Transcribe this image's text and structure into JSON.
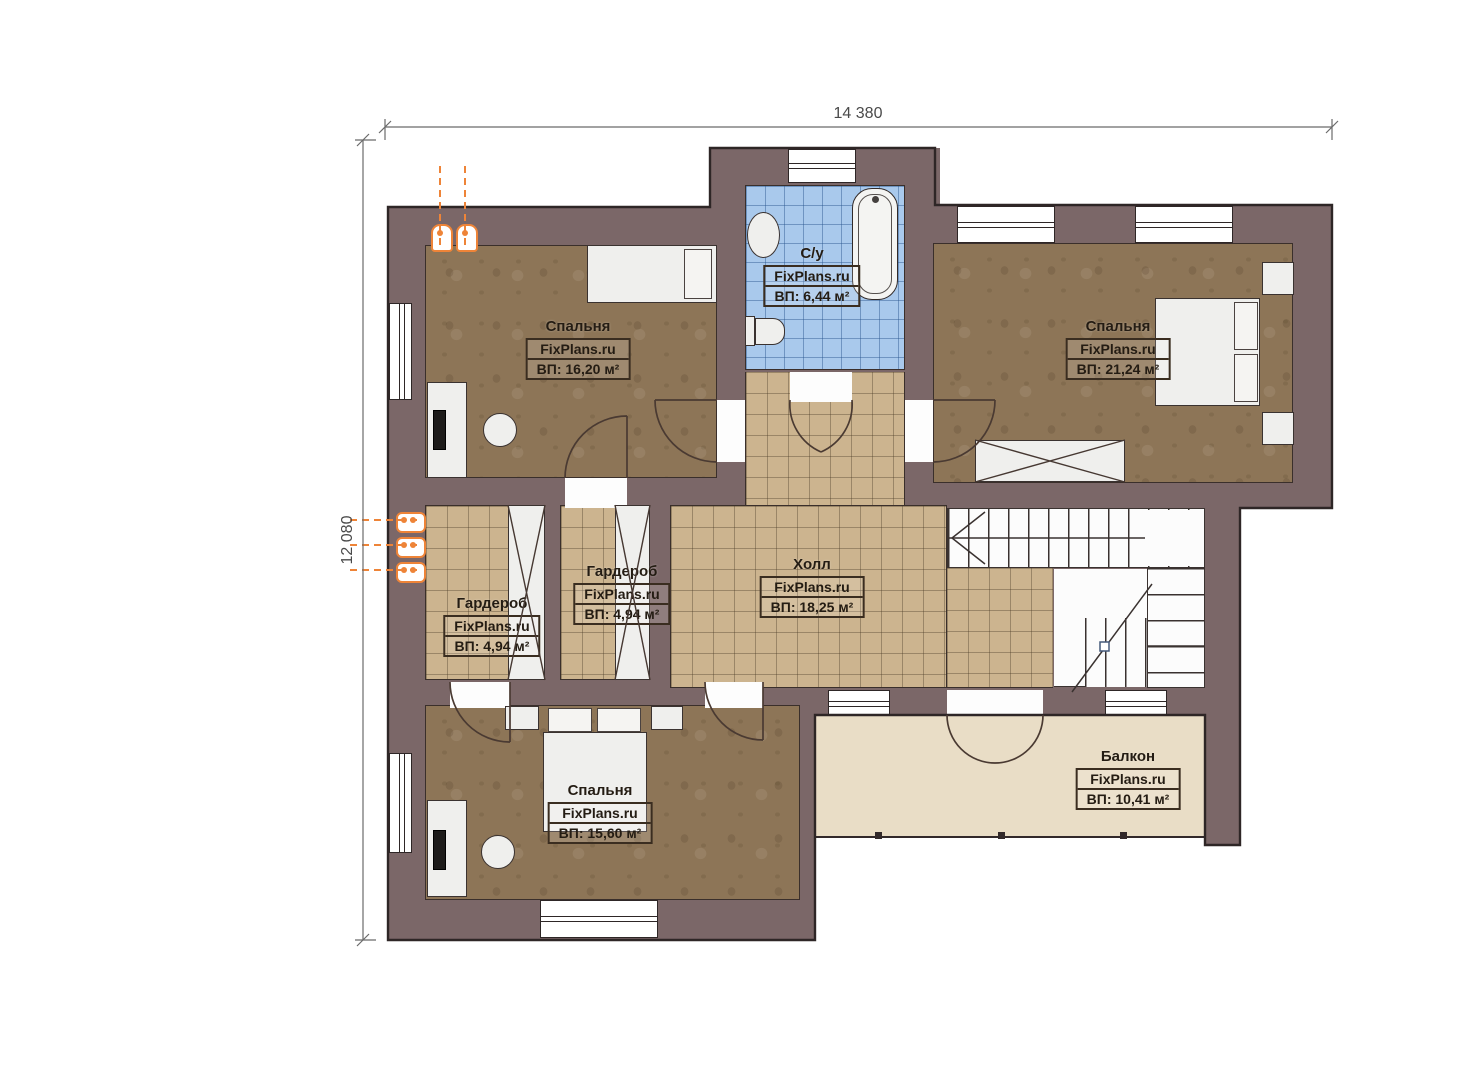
{
  "title": "Floor plan",
  "watermark": "FixPlans.ru",
  "dimensions": {
    "top": "14 380",
    "left": "12 080"
  },
  "rooms": [
    {
      "id": "bedroom-top-left",
      "name": "Спальня",
      "brand": "FixPlans.ru",
      "area": "ВП: 16,20 м²"
    },
    {
      "id": "bathroom",
      "name": "С/у",
      "brand": "FixPlans.ru",
      "area": "ВП: 6,44 м²"
    },
    {
      "id": "bedroom-top-right",
      "name": "Спальня",
      "brand": "FixPlans.ru",
      "area": "ВП: 21,24 м²"
    },
    {
      "id": "wardrobe-left",
      "name": "Гардероб",
      "brand": "FixPlans.ru",
      "area": "ВП: 4,94 м²"
    },
    {
      "id": "wardrobe-middle",
      "name": "Гардероб",
      "brand": "FixPlans.ru",
      "area": "ВП: 4,94 м²"
    },
    {
      "id": "hall",
      "name": "Холл",
      "brand": "FixPlans.ru",
      "area": "ВП: 18,25 м²"
    },
    {
      "id": "bedroom-bottom",
      "name": "Спальня",
      "brand": "FixPlans.ru",
      "area": "ВП: 15,60 м²"
    },
    {
      "id": "balcony",
      "name": "Балкон",
      "brand": "FixPlans.ru",
      "area": "ВП: 10,41 м²"
    }
  ],
  "colors": {
    "wall": "#7b6768",
    "outline": "#2e2626",
    "bedroom_floor": "#8d7557",
    "tile_floor": "#ccb48f",
    "bath_tile": "#a9c9ec",
    "balcony_floor": "#e9ddc6",
    "radiator_accent": "#ee8438"
  }
}
